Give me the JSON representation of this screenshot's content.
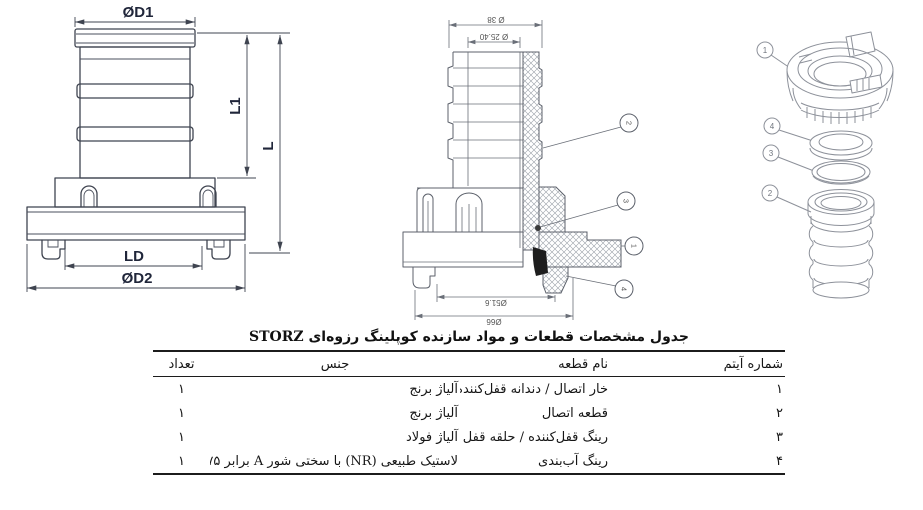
{
  "title": "جدول مشخصات قطعات و مواد سازنده کوپلینگ رزوه‌ای STORZ",
  "drawings": {
    "front_view": {
      "dims": {
        "d1": "ØD1",
        "l1": "L1",
        "l": "L",
        "ld": "LD",
        "d2": "ØD2"
      }
    },
    "section_view": {
      "dims": {
        "top_outer": "Ø 38",
        "top_inner": "Ø 25.40",
        "bottom_inner": "Ø51.6",
        "bottom_outer": "Ø66"
      },
      "callouts": {
        "c1": "1",
        "c2": "2",
        "c3": "3",
        "c4": "4"
      }
    },
    "exploded_view": {
      "callouts": {
        "c1": "1",
        "c2": "2",
        "c3": "3",
        "c4": "4"
      }
    }
  },
  "table": {
    "headers": {
      "item": "شماره آیتم",
      "name": "نام قطعه",
      "material": "جنس",
      "qty": "تعداد"
    },
    "rows": [
      {
        "item": "۱",
        "name": "خار اتصال / دندانه قفل‌کننده",
        "material": "آلیاژ برنج",
        "qty": "۱"
      },
      {
        "item": "۲",
        "name": "قطعه اتصال",
        "material": "آلیاژ برنج",
        "qty": "۱"
      },
      {
        "item": "۳",
        "name": "رینگ قفل‌کننده / حلقه قفل",
        "material": "آلیاژ فولاد",
        "qty": "۱"
      },
      {
        "item": "۴",
        "name": "رینگ آب‌بندی",
        "material": "لاستیک طبیعی (NR) با سختی شور A برابر ۷۵±۵",
        "qty": "۱"
      }
    ]
  }
}
